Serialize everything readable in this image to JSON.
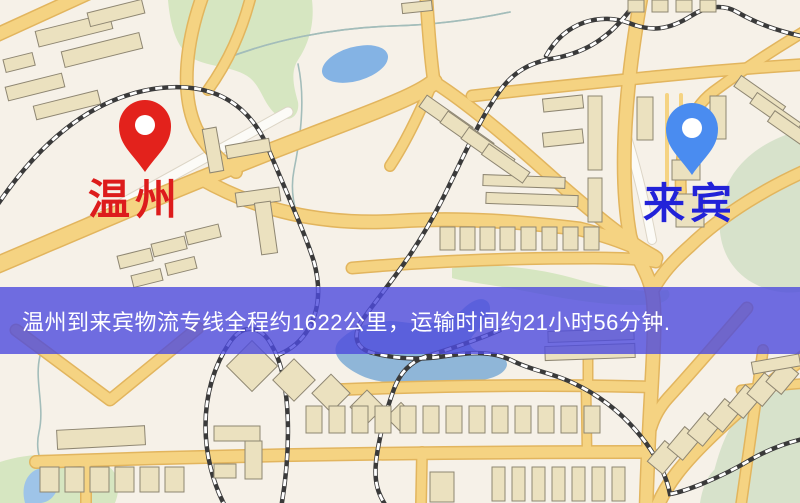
{
  "map": {
    "origin": {
      "label": "温州",
      "marker_color": "#e3221c",
      "label_color": "#dd1c1c"
    },
    "destination": {
      "label": "来宾",
      "marker_color": "#4a8cf0",
      "label_color": "#2222d8"
    },
    "banner": {
      "text": "温州到来宾物流专线全程约1622公里，运输时间约21小时56分钟.",
      "background_color": "#4d4bdd",
      "background_opacity": "0.80",
      "text_color": "#ffffff"
    },
    "palette": {
      "land": "#f6f1e8",
      "road_fill": "#f5d382",
      "road_casing": "#e2b55e",
      "minor_road": "#fcfbf7",
      "park_green": "#d6e6c1",
      "sage_green": "#d7e2cb",
      "water_blue": "#84b3e4",
      "river_blue": "#8fb6d8",
      "railway_dark": "#3a3a3a",
      "building_fill": "#ebe1bf",
      "building_stroke": "#8e8672"
    }
  }
}
